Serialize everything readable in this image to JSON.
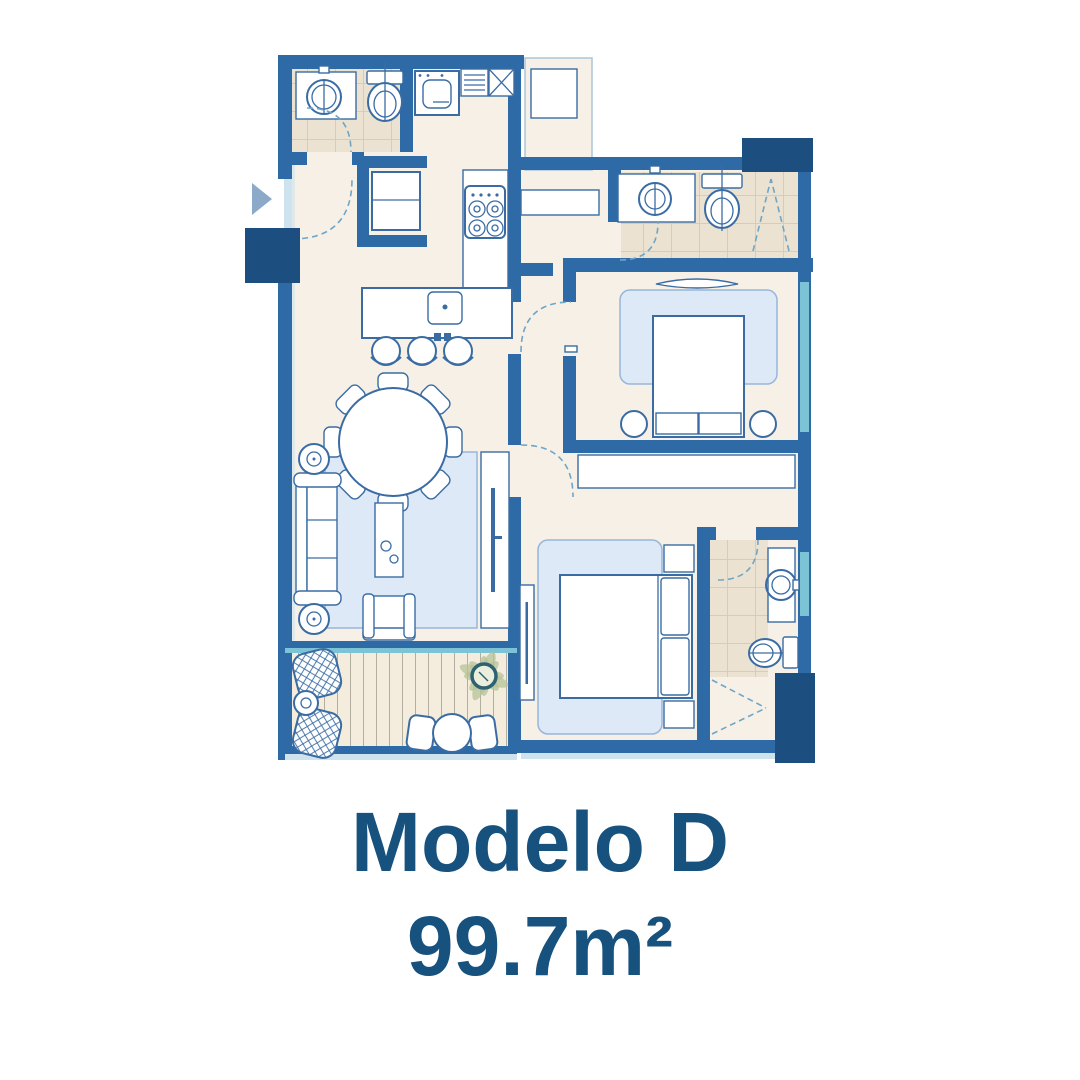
{
  "title": {
    "model": "Modelo D",
    "area": "99.7m²"
  },
  "colors": {
    "wall": "#2e6aa6",
    "wall_dark": "#1d4e80",
    "line": "#3a6ca3",
    "door": "#6fa6c6",
    "floor": "#f7f0e7",
    "tile": "#ebe2d1",
    "tile_line": "#d8ccb6",
    "rug": "#dde9f6",
    "rug_line": "#97b6da",
    "deck": "#f4edde",
    "deck_line": "#b2aea0",
    "window": "#7cc3d6",
    "window_light": "#cfe3ef",
    "text": "#17517e",
    "arrow": "#8ca9c9",
    "plant": "#b5c297",
    "plant_pot": "#2e6273"
  }
}
